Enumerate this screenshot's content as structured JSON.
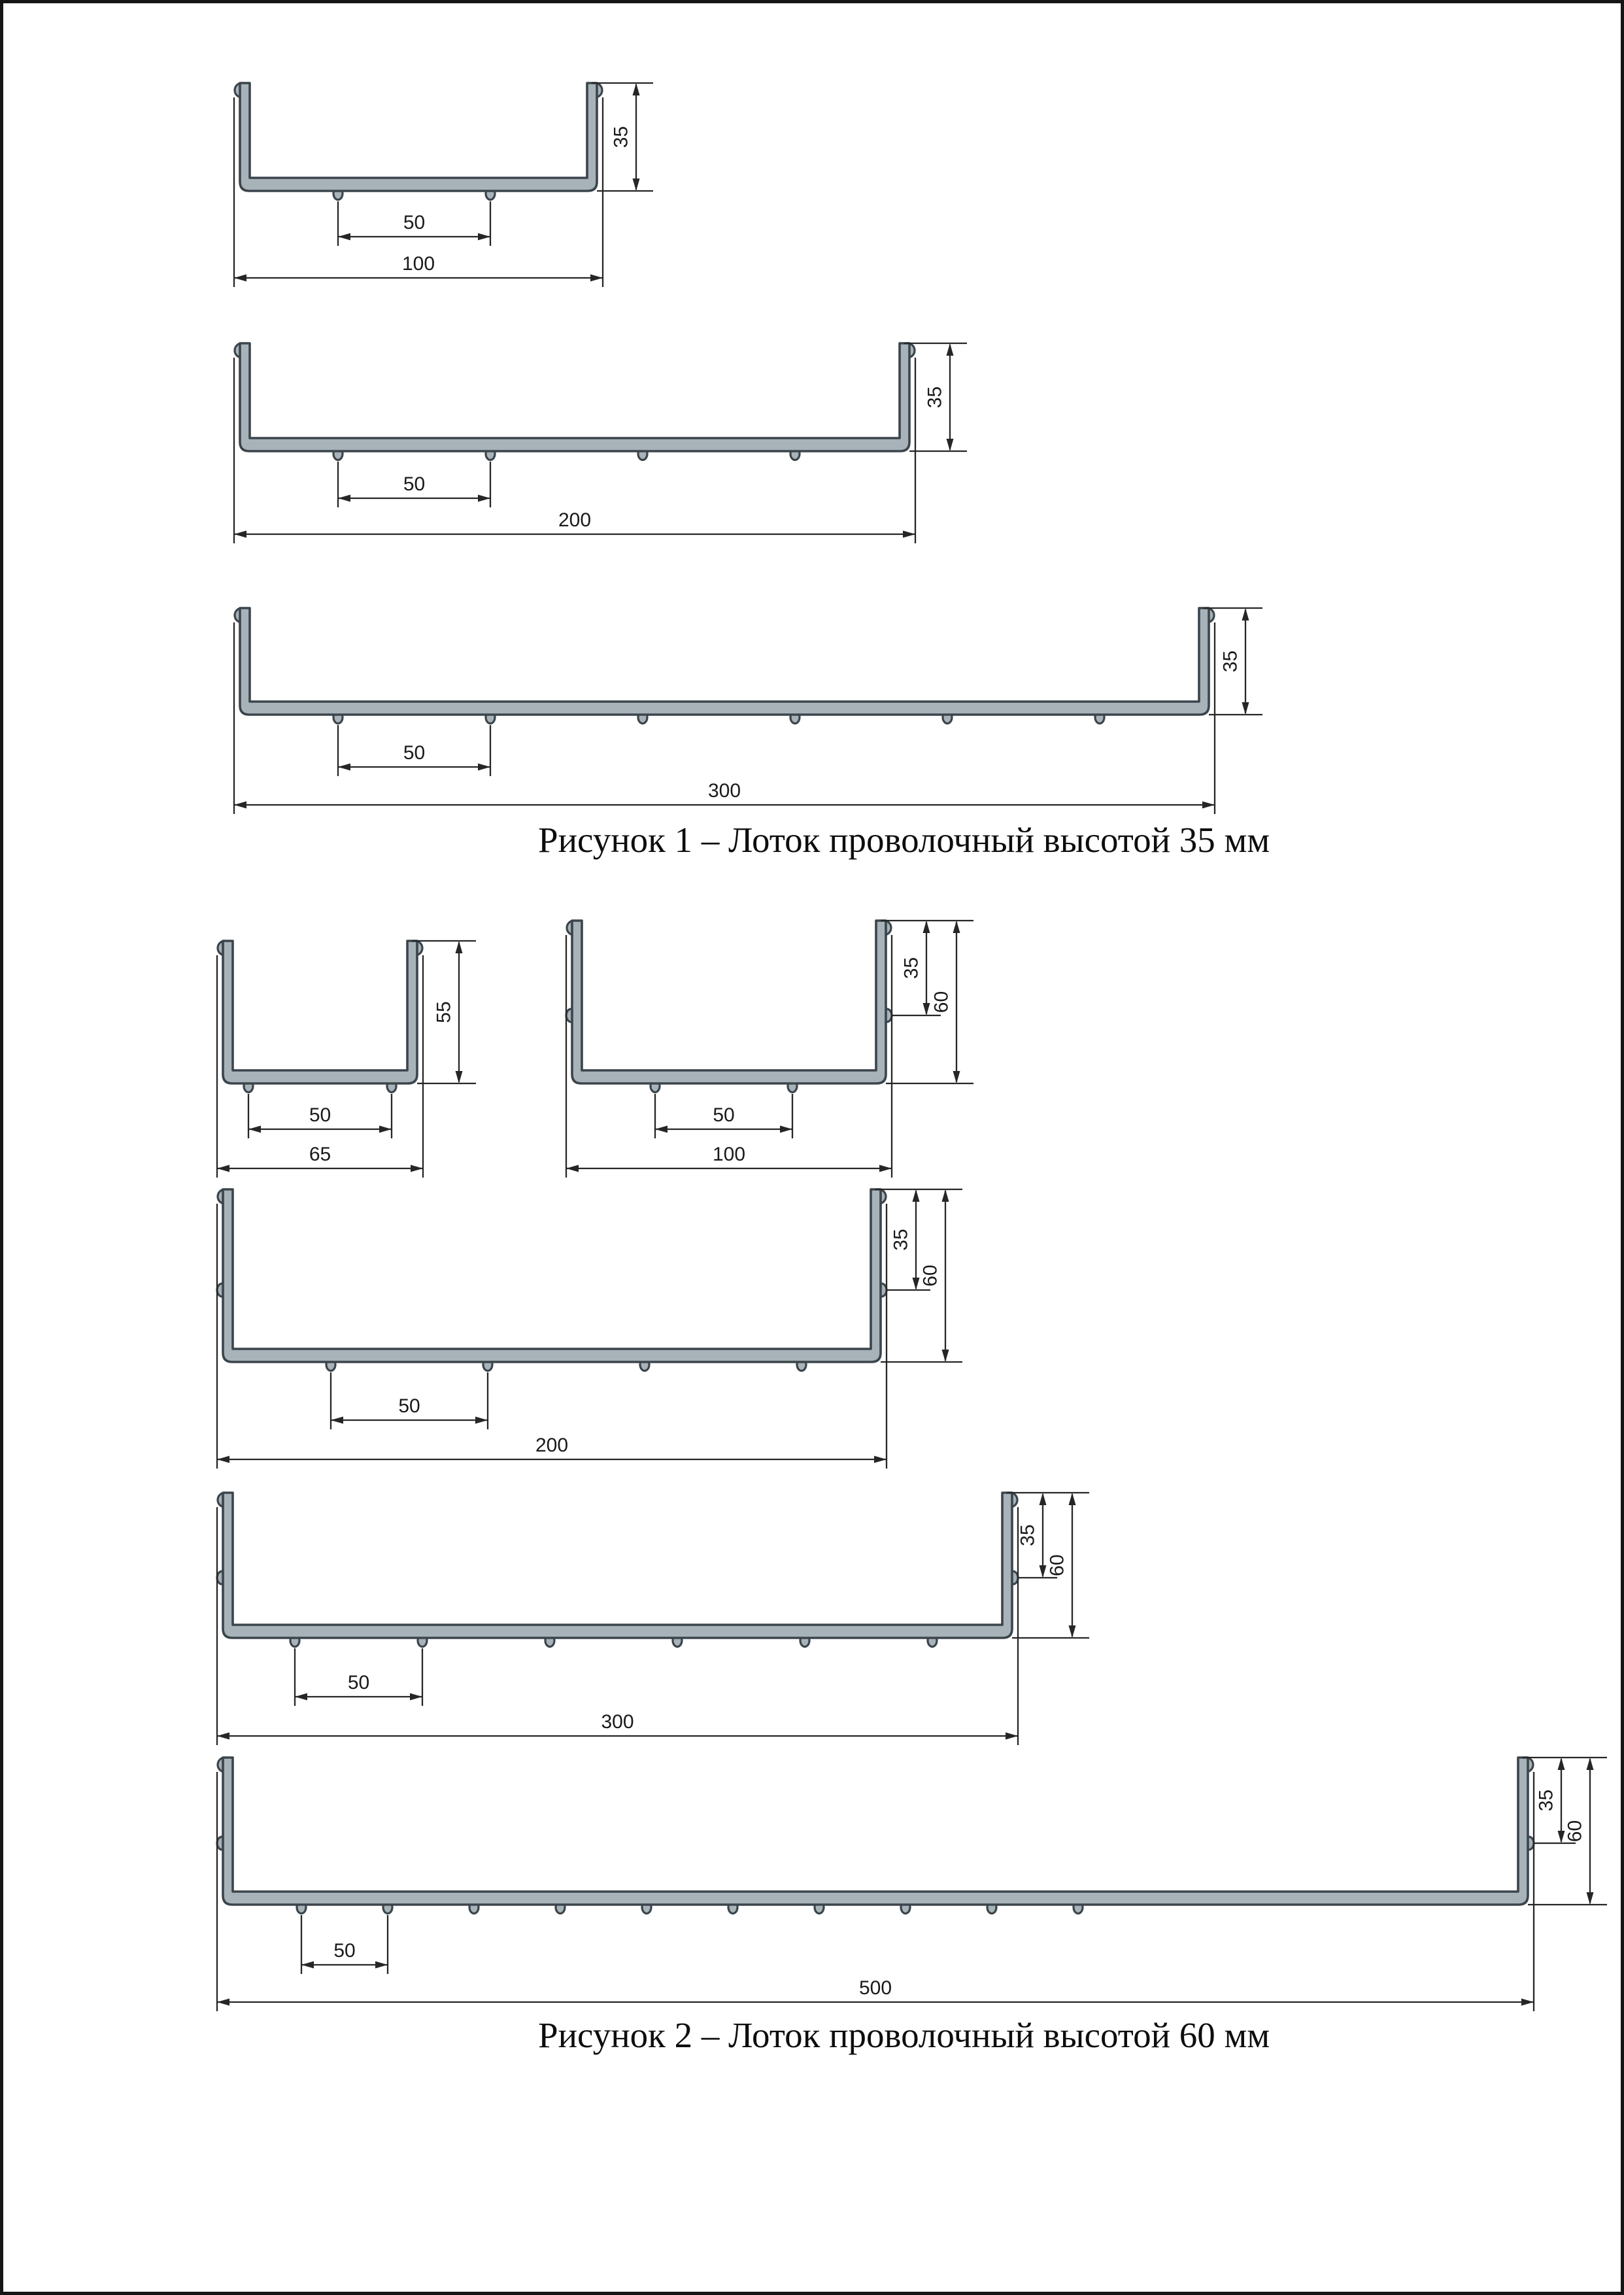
{
  "page": {
    "background": "#ffffff",
    "description": "Scanned technical drawing page with wire cable tray cross-sections"
  },
  "colors": {
    "profile_fill": "#a7b3b8",
    "profile_stroke": "#3b454b",
    "dimension_line": "#262626",
    "text": "#1a1a1a",
    "page_border": "#161616"
  },
  "figures": [
    {
      "caption": "Рисунок 1 – Лоток проволочный высотой 35 мм",
      "trays": [
        {
          "id": "100x35",
          "width_label": "100",
          "wire_spacing_label": "50",
          "height_labels": [
            "35"
          ]
        },
        {
          "id": "200x35",
          "width_label": "200",
          "wire_spacing_label": "50",
          "height_labels": [
            "35"
          ]
        },
        {
          "id": "300x35",
          "width_label": "300",
          "wire_spacing_label": "50",
          "height_labels": [
            "35"
          ]
        }
      ]
    },
    {
      "caption": "Рисунок 2 – Лоток проволочный высотой 60 мм",
      "trays": [
        {
          "id": "65x55",
          "width_label": "65",
          "wire_spacing_label": "50",
          "height_labels": [
            "55"
          ]
        },
        {
          "id": "100x60",
          "width_label": "100",
          "wire_spacing_label": "50",
          "height_labels": [
            "35",
            "60"
          ]
        },
        {
          "id": "200x60",
          "width_label": "200",
          "wire_spacing_label": "50",
          "height_labels": [
            "35",
            "60"
          ]
        },
        {
          "id": "300x60",
          "width_label": "300",
          "wire_spacing_label": "50",
          "height_labels": [
            "35",
            "60"
          ]
        },
        {
          "id": "500x60",
          "width_label": "500",
          "wire_spacing_label": "50",
          "height_labels": [
            "35",
            "60"
          ]
        }
      ]
    }
  ]
}
